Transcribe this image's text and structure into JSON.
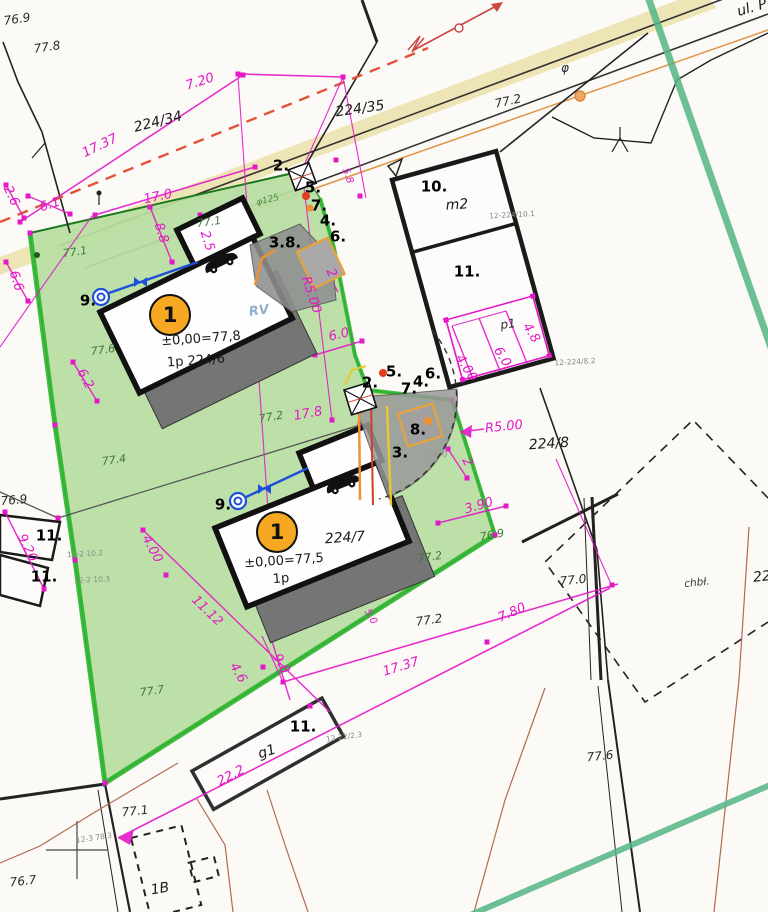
{
  "colors": {
    "dimension_magenta": "#e318c8",
    "parcel_fill_green": "#b9dfa3",
    "parcel_border_green": "#2db52d",
    "building_marker_orange": "#f7a823",
    "water_line_blue": "#1f4fd8",
    "boundary_dashed_red": "#e2543a",
    "road_band_tan": "#ece2ae",
    "utility_orange": "#e09040",
    "shadow_gray": "#757575"
  },
  "building_markers": {
    "b1": "1",
    "b2": "1"
  },
  "labels": [
    {
      "t": "76.9",
      "x": 17,
      "y": 19,
      "r": -8,
      "c": "blk"
    },
    {
      "t": "77.8",
      "x": 47,
      "y": 47,
      "r": -8,
      "c": "blk"
    },
    {
      "t": "224/34",
      "x": 158,
      "y": 122,
      "r": -14,
      "c": "parcel"
    },
    {
      "t": "224/35",
      "x": 360,
      "y": 109,
      "r": -8,
      "c": "parcel"
    },
    {
      "t": "7.20",
      "x": 200,
      "y": 82,
      "r": -18,
      "c": "dim"
    },
    {
      "t": "17.37",
      "x": 100,
      "y": 146,
      "r": -26,
      "c": "dim"
    },
    {
      "t": "17.0",
      "x": 158,
      "y": 197,
      "r": -12,
      "c": "dim"
    },
    {
      "t": "8.8",
      "x": 161,
      "y": 233,
      "r": 72,
      "c": "dim"
    },
    {
      "t": "2.5",
      "x": 207,
      "y": 241,
      "r": 72,
      "c": "dim"
    },
    {
      "t": "2.6",
      "x": 11,
      "y": 196,
      "r": 65,
      "c": "dim"
    },
    {
      "t": "6.1",
      "x": 50,
      "y": 205,
      "r": -18,
      "c": "dim"
    },
    {
      "t": "6.6",
      "x": 16,
      "y": 281,
      "r": 72,
      "c": "dim"
    },
    {
      "t": "6.2",
      "x": 85,
      "y": 379,
      "r": 62,
      "c": "dim"
    },
    {
      "t": "9.20",
      "x": 27,
      "y": 548,
      "r": 64,
      "c": "dim"
    },
    {
      "t": "4.00",
      "x": 152,
      "y": 549,
      "r": 62,
      "c": "dim"
    },
    {
      "t": "11.12",
      "x": 207,
      "y": 611,
      "r": 44,
      "c": "dim"
    },
    {
      "t": "4.6",
      "x": 238,
      "y": 673,
      "r": 60,
      "c": "dim"
    },
    {
      "t": "9.0",
      "x": 281,
      "y": 664,
      "r": 60,
      "c": "dim"
    },
    {
      "t": "5.0",
      "x": 370,
      "y": 617,
      "r": 60,
      "c": "dimS"
    },
    {
      "t": "17.37",
      "x": 401,
      "y": 667,
      "r": -17,
      "c": "dim"
    },
    {
      "t": "7.80",
      "x": 512,
      "y": 613,
      "r": -24,
      "c": "dim"
    },
    {
      "t": "22.2",
      "x": 231,
      "y": 776,
      "r": -28,
      "c": "dim"
    },
    {
      "t": "R5.00",
      "x": 311,
      "y": 295,
      "r": 72,
      "c": "dim"
    },
    {
      "t": "2",
      "x": 331,
      "y": 273,
      "r": 65,
      "c": "dim"
    },
    {
      "t": "6.0",
      "x": 339,
      "y": 335,
      "r": -14,
      "c": "dim"
    },
    {
      "t": "R5.00",
      "x": 504,
      "y": 427,
      "r": -6,
      "c": "dim"
    },
    {
      "t": "2",
      "x": 467,
      "y": 462,
      "r": 62,
      "c": "dim"
    },
    {
      "t": "3.90",
      "x": 479,
      "y": 506,
      "r": -16,
      "c": "dim"
    },
    {
      "t": "4.8",
      "x": 531,
      "y": 333,
      "r": 58,
      "c": "dim"
    },
    {
      "t": "6.0",
      "x": 502,
      "y": 357,
      "r": 58,
      "c": "dim"
    },
    {
      "t": "4.00",
      "x": 466,
      "y": 368,
      "r": 58,
      "c": "dim"
    },
    {
      "t": "17.8",
      "x": 308,
      "y": 414,
      "r": -10,
      "c": "dim"
    },
    {
      "t": "5.8",
      "x": 347,
      "y": 176,
      "r": 70,
      "c": "dimS"
    },
    {
      "t": "77.2",
      "x": 271,
      "y": 417,
      "r": -10,
      "c": "grn"
    },
    {
      "t": "77.1",
      "x": 75,
      "y": 252,
      "r": -8,
      "c": "grn"
    },
    {
      "t": "77.1",
      "x": 209,
      "y": 222,
      "r": -8,
      "c": "grn"
    },
    {
      "t": "77.6",
      "x": 103,
      "y": 350,
      "r": -8,
      "c": "grn"
    },
    {
      "t": "77.4",
      "x": 114,
      "y": 460,
      "r": -8,
      "c": "grn"
    },
    {
      "t": "77.7",
      "x": 152,
      "y": 691,
      "r": -8,
      "c": "grn"
    },
    {
      "t": "77.2",
      "x": 430,
      "y": 557,
      "r": -8,
      "c": "grn"
    },
    {
      "t": "77.2",
      "x": 429,
      "y": 620,
      "r": -8,
      "c": "blk"
    },
    {
      "t": "77.2",
      "x": 508,
      "y": 101,
      "r": -12,
      "c": "blk"
    },
    {
      "t": "76.9",
      "x": 14,
      "y": 500,
      "r": -5,
      "c": "blk"
    },
    {
      "t": "76.9",
      "x": 492,
      "y": 535,
      "r": -10,
      "c": "grn"
    },
    {
      "t": "76.6",
      "x": 437,
      "y": 456,
      "r": -10,
      "c": "gry"
    },
    {
      "t": "77.0",
      "x": 573,
      "y": 580,
      "r": -6,
      "c": "blk"
    },
    {
      "t": "77.6",
      "x": 600,
      "y": 756,
      "r": -6,
      "c": "blk"
    },
    {
      "t": "77.1",
      "x": 135,
      "y": 811,
      "r": -6,
      "c": "blk"
    },
    {
      "t": "76.7",
      "x": 23,
      "y": 881,
      "r": -6,
      "c": "blk"
    },
    {
      "t": "chbł.",
      "x": 697,
      "y": 583,
      "r": -6,
      "c": "blkS"
    },
    {
      "t": "22",
      "x": 762,
      "y": 577,
      "r": -6,
      "c": "parcel"
    },
    {
      "t": "224/8",
      "x": 549,
      "y": 444,
      "r": -4,
      "c": "parcel"
    },
    {
      "t": "224/7",
      "x": 345,
      "y": 538,
      "r": -4,
      "c": "parcel"
    },
    {
      "t": "±0,00=77,8",
      "x": 201,
      "y": 339,
      "r": -4,
      "c": "bld"
    },
    {
      "t": "1p 224/6",
      "x": 196,
      "y": 361,
      "r": -4,
      "c": "bld"
    },
    {
      "t": "±0,00=77,5",
      "x": 284,
      "y": 561,
      "r": -4,
      "c": "bld"
    },
    {
      "t": "1p",
      "x": 281,
      "y": 579,
      "r": -4,
      "c": "bld"
    },
    {
      "t": "RV",
      "x": 259,
      "y": 311,
      "r": -8,
      "c": "blu"
    },
    {
      "t": "m2",
      "x": 457,
      "y": 205,
      "r": -4,
      "c": "parcel"
    },
    {
      "t": "10.",
      "x": 434,
      "y": 187,
      "r": 0,
      "c": "bold"
    },
    {
      "t": "11.",
      "x": 467,
      "y": 272,
      "r": 0,
      "c": "bold"
    },
    {
      "t": "11.",
      "x": 49,
      "y": 536,
      "r": 0,
      "c": "bold"
    },
    {
      "t": "11.",
      "x": 44,
      "y": 577,
      "r": 0,
      "c": "bold"
    },
    {
      "t": "11.",
      "x": 303,
      "y": 727,
      "r": 0,
      "c": "bold"
    },
    {
      "t": "p1",
      "x": 508,
      "y": 324,
      "r": -8,
      "c": "blk"
    },
    {
      "t": "g1",
      "x": 267,
      "y": 752,
      "r": -18,
      "c": "parcel"
    },
    {
      "t": "1B",
      "x": 160,
      "y": 889,
      "r": -10,
      "c": "parcel"
    },
    {
      "t": "2.",
      "x": 281,
      "y": 166,
      "r": 0,
      "c": "bold"
    },
    {
      "t": "5.",
      "x": 313,
      "y": 188,
      "r": 0,
      "c": "bold"
    },
    {
      "t": "7.",
      "x": 319,
      "y": 206,
      "r": 0,
      "c": "bold"
    },
    {
      "t": "4.",
      "x": 328,
      "y": 221,
      "r": 0,
      "c": "bold"
    },
    {
      "t": "6.",
      "x": 338,
      "y": 237,
      "r": 0,
      "c": "bold"
    },
    {
      "t": "3.8.",
      "x": 285,
      "y": 243,
      "r": 0,
      "c": "bold"
    },
    {
      "t": "2.",
      "x": 370,
      "y": 383,
      "r": 0,
      "c": "bold"
    },
    {
      "t": "5.",
      "x": 394,
      "y": 372,
      "r": 0,
      "c": "bold"
    },
    {
      "t": "7.",
      "x": 409,
      "y": 389,
      "r": 0,
      "c": "bold"
    },
    {
      "t": "4.",
      "x": 421,
      "y": 382,
      "r": 0,
      "c": "bold"
    },
    {
      "t": "6.",
      "x": 433,
      "y": 374,
      "r": 0,
      "c": "bold"
    },
    {
      "t": "8.",
      "x": 418,
      "y": 430,
      "r": 0,
      "c": "bold"
    },
    {
      "t": "3.",
      "x": 400,
      "y": 453,
      "r": 0,
      "c": "bold"
    },
    {
      "t": "9.",
      "x": 88,
      "y": 301,
      "r": 0,
      "c": "bold"
    },
    {
      "t": "9.",
      "x": 223,
      "y": 505,
      "r": 0,
      "c": "bold"
    },
    {
      "t": "φ125",
      "x": 268,
      "y": 201,
      "r": -14,
      "c": "grnS"
    },
    {
      "t": "φ",
      "x": 565,
      "y": 68,
      "r": 0,
      "c": "blk"
    },
    {
      "t": "ul. P",
      "x": 752,
      "y": 8,
      "r": -16,
      "c": "parcel"
    },
    {
      "t": "12-224/10.1",
      "x": 512,
      "y": 215,
      "r": -3,
      "c": "tiny"
    },
    {
      "t": "12-224/8.2",
      "x": 575,
      "y": 362,
      "r": -3,
      "c": "tiny"
    },
    {
      "t": "12-2 10.2",
      "x": 85,
      "y": 554,
      "r": -3,
      "c": "tiny"
    },
    {
      "t": "12-2 10.3",
      "x": 92,
      "y": 580,
      "r": -3,
      "c": "tiny"
    },
    {
      "t": "12-22/2.3",
      "x": 344,
      "y": 737,
      "r": -8,
      "c": "tiny"
    },
    {
      "t": "12-3 78.3",
      "x": 94,
      "y": 838,
      "r": -8,
      "c": "tiny"
    }
  ]
}
